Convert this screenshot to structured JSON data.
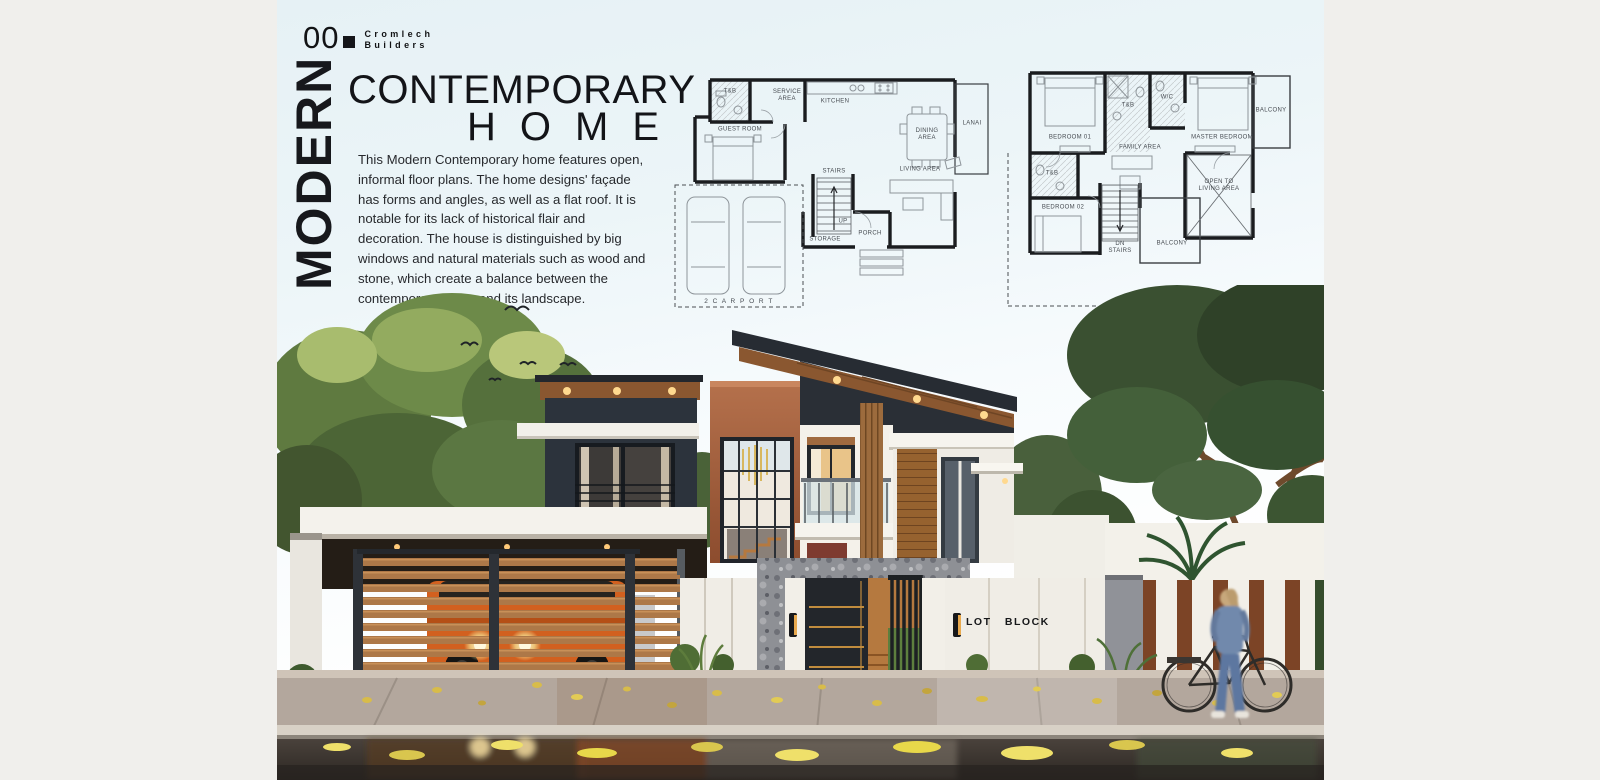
{
  "poster": {
    "brand": {
      "number": "00",
      "line1": "Cromlech",
      "line2": "Builders"
    },
    "title": {
      "vertical": "MODERN",
      "main": "CONTEMPORARY",
      "sub": "HOME"
    },
    "description": "This Modern Contemporary home features open, informal floor plans. The home designs' façade has forms and angles, as well as a flat roof. It is notable for its lack of historical flair and decoration. The house is distinguished by big windows and natural materials such as wood and stone, which create a balance between the contemporary home and its landscape."
  },
  "floor_plans": {
    "ground_floor": {
      "labels": {
        "tb": "T&B",
        "service": "SERVICE\nAREA",
        "kitchen": "KITCHEN",
        "dining": "DINING\nAREA",
        "lanai": "LANAI",
        "guest": "GUEST ROOM",
        "living": "LIVING AREA",
        "stairs": "STAIRS",
        "up": "UP",
        "storage": "STORAGE",
        "porch": "PORCH",
        "carport": "2 C A R P O R T"
      }
    },
    "second_floor": {
      "labels": {
        "bedroom01": "BEDROOM 01",
        "tb_top": "T&B",
        "wc": "W/C",
        "master": "MASTER BEDROOM",
        "balcony_top": "BALCONY",
        "family": "FAMILY AREA",
        "open_to": "OPEN TO\nLIVING AREA",
        "tb_left": "T&B",
        "bedroom02": "BEDROOM 02",
        "dn_stairs": "DN\nSTAIRS",
        "balcony_bottom": "BALCONY"
      }
    }
  },
  "render_scene": {
    "gate_sign": "LOT BLOCK"
  },
  "colors": {
    "margin": "#f0efec",
    "sky": "#ecf5f8",
    "ink": "#17181c",
    "terracotta": "#a7613d",
    "roof_charcoal": "#2a2f36",
    "wood": "#a9744a",
    "suv_orange": "#d2601f",
    "corten": "#7c4426",
    "leaf_yellow": "#e5d45a"
  }
}
